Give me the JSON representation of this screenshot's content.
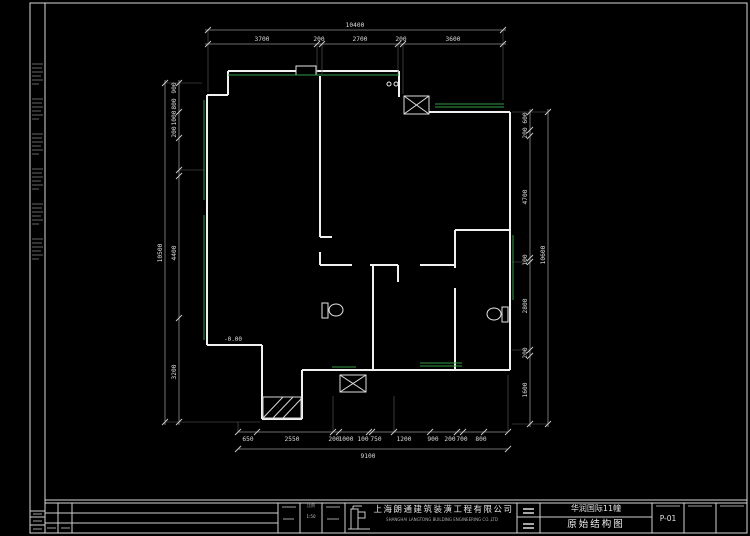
{
  "drawing": {
    "level_annotation": "-0.00",
    "dimensions": {
      "top": {
        "total": "10400",
        "segments": [
          "3700",
          "200",
          "2700",
          "200",
          "3600"
        ]
      },
      "bottom": {
        "total": "9100",
        "segments": [
          "650",
          "2550",
          "200",
          "1000",
          "100",
          "750",
          "1200",
          "900",
          "200",
          "700",
          "800"
        ]
      },
      "left": {
        "total": "10500",
        "segments": [
          "900",
          "800",
          "1000",
          "200",
          "4400",
          "3200"
        ]
      },
      "right": {
        "total": "10600",
        "segments": [
          "600",
          "200",
          "4700",
          "100",
          "2800",
          "200",
          "1600"
        ]
      }
    }
  },
  "title_block": {
    "company_cn": "上海朗通建筑装潢工程有限公司",
    "company_en": "SHANGHAI LANGTONG BUILDING ENGINEERING CO.,LTD",
    "project_name": "华润国际11幢",
    "drawing_title": "原始结构图",
    "sheet_number": "P-01",
    "scale_label": "比例",
    "scale_value": "1:50"
  }
}
